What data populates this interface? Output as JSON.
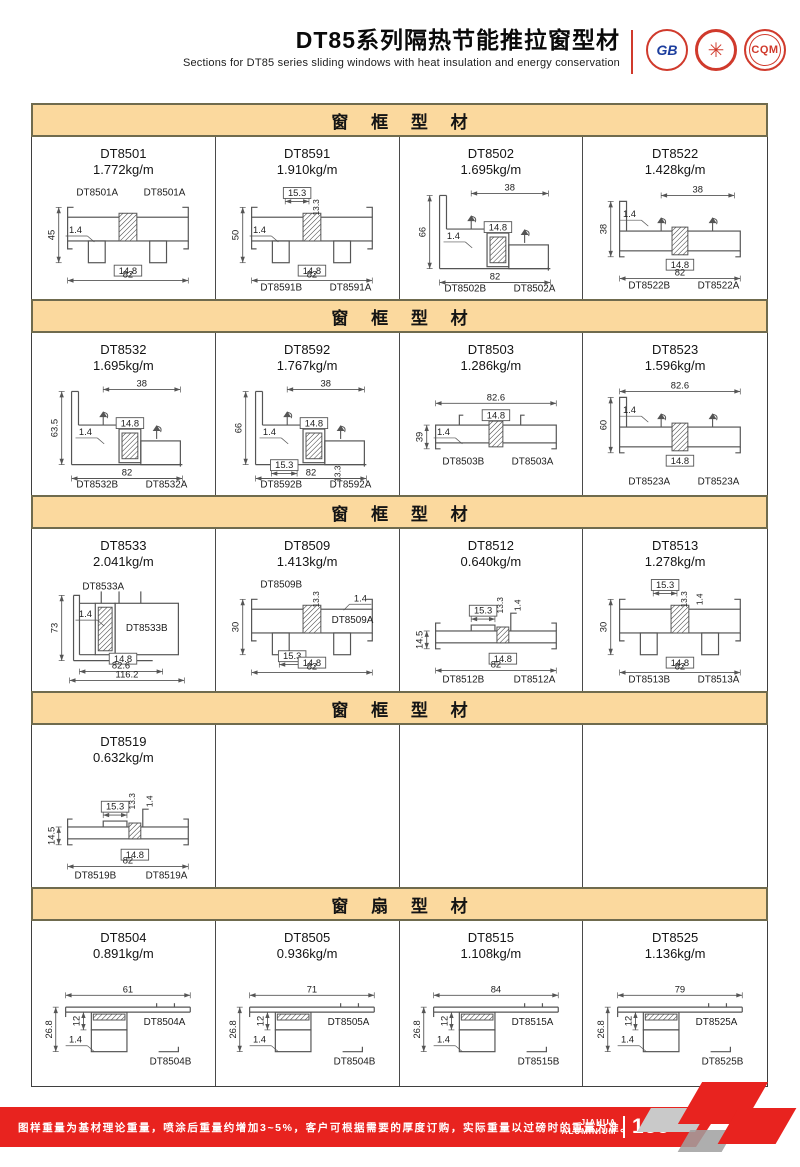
{
  "header": {
    "title": "DT85系列隔热节能推拉窗型材",
    "subtitle": "Sections for DT85 series sliding windows with heat insulation and energy conservation",
    "logos": [
      {
        "name": "gb-certification-logo",
        "text": "GB"
      },
      {
        "name": "star-seal-logo",
        "text": "✳"
      },
      {
        "name": "cqm-certification-logo",
        "text": "CQM"
      }
    ]
  },
  "sections": [
    {
      "title": "窗 框 型 材",
      "cells": [
        {
          "code": "DT8501",
          "weight": "1.772kg/m",
          "shape": "flat",
          "labels": [
            {
              "text": "DT8501A",
              "slot": "tl"
            },
            {
              "text": "DT8501A",
              "slot": "tr"
            }
          ],
          "dims": [
            {
              "text": "45",
              "slot": "left"
            },
            {
              "text": "1.4",
              "slot": "wall"
            },
            {
              "text": "14.8",
              "slot": "mid"
            },
            {
              "text": "82",
              "slot": "bottom"
            }
          ]
        },
        {
          "code": "DT8591",
          "weight": "1.910kg/m",
          "shape": "flat",
          "labels": [
            {
              "text": "DT8591B",
              "slot": "bl"
            },
            {
              "text": "DT8591A",
              "slot": "br"
            }
          ],
          "dims": [
            {
              "text": "15.3",
              "slot": "top2"
            },
            {
              "text": "13.3",
              "slot": "topv"
            },
            {
              "text": "50",
              "slot": "left"
            },
            {
              "text": "1.4",
              "slot": "wall"
            },
            {
              "text": "14.8",
              "slot": "mid"
            },
            {
              "text": "82",
              "slot": "bottom"
            }
          ]
        },
        {
          "code": "DT8502",
          "weight": "1.695kg/m",
          "shape": "step",
          "labels": [
            {
              "text": "DT8502B",
              "slot": "bl"
            },
            {
              "text": "DT8502A",
              "slot": "br"
            }
          ],
          "dims": [
            {
              "text": "38",
              "slot": "topp"
            },
            {
              "text": "66",
              "slot": "left"
            },
            {
              "text": "1.4",
              "slot": "wall"
            },
            {
              "text": "14.8",
              "slot": "mid"
            },
            {
              "text": "82",
              "slot": "bottom"
            }
          ]
        },
        {
          "code": "DT8522",
          "weight": "1.428kg/m",
          "shape": "hook",
          "labels": [
            {
              "text": "DT8522B",
              "slot": "bl"
            },
            {
              "text": "DT8522A",
              "slot": "br"
            }
          ],
          "dims": [
            {
              "text": "38",
              "slot": "topp"
            },
            {
              "text": "1.4",
              "slot": "wall"
            },
            {
              "text": "38",
              "slot": "left"
            },
            {
              "text": "14.8",
              "slot": "mid"
            },
            {
              "text": "82",
              "slot": "bottom"
            }
          ]
        }
      ]
    },
    {
      "title": "窗 框 型 材",
      "cells": [
        {
          "code": "DT8532",
          "weight": "1.695kg/m",
          "shape": "step",
          "labels": [
            {
              "text": "DT8532B",
              "slot": "bl"
            },
            {
              "text": "DT8532A",
              "slot": "br"
            }
          ],
          "dims": [
            {
              "text": "38",
              "slot": "topp"
            },
            {
              "text": "63.5",
              "slot": "left"
            },
            {
              "text": "1.4",
              "slot": "wall"
            },
            {
              "text": "14.8",
              "slot": "mid"
            },
            {
              "text": "82",
              "slot": "bottom"
            }
          ]
        },
        {
          "code": "DT8592",
          "weight": "1.767kg/m",
          "shape": "step",
          "labels": [
            {
              "text": "DT8592B",
              "slot": "bl"
            },
            {
              "text": "DT8592A",
              "slot": "br"
            }
          ],
          "dims": [
            {
              "text": "38",
              "slot": "topp"
            },
            {
              "text": "66",
              "slot": "left"
            },
            {
              "text": "1.4",
              "slot": "wall"
            },
            {
              "text": "14.8",
              "slot": "mid"
            },
            {
              "text": "15.3",
              "slot": "bottom2"
            },
            {
              "text": "13.3",
              "slot": "botv"
            },
            {
              "text": "82",
              "slot": "bottom"
            }
          ]
        },
        {
          "code": "DT8503",
          "weight": "1.286kg/m",
          "shape": "low",
          "labels": [
            {
              "text": "DT8503B",
              "slot": "bl"
            },
            {
              "text": "DT8503A",
              "slot": "br"
            }
          ],
          "dims": [
            {
              "text": "82.6",
              "slot": "top"
            },
            {
              "text": "1.4",
              "slot": "wall"
            },
            {
              "text": "14.8",
              "slot": "mid"
            },
            {
              "text": "39",
              "slot": "left"
            }
          ]
        },
        {
          "code": "DT8523",
          "weight": "1.596kg/m",
          "shape": "hook",
          "labels": [
            {
              "text": "DT8523A",
              "slot": "bl"
            },
            {
              "text": "DT8523A",
              "slot": "br"
            }
          ],
          "dims": [
            {
              "text": "82.6",
              "slot": "top"
            },
            {
              "text": "1.4",
              "slot": "wall"
            },
            {
              "text": "60",
              "slot": "left"
            },
            {
              "text": "14.8",
              "slot": "mid"
            }
          ]
        }
      ]
    },
    {
      "title": "窗 框 型 材",
      "cells": [
        {
          "code": "DT8533",
          "weight": "2.041kg/m",
          "shape": "wide",
          "labels": [
            {
              "text": "DT8533A",
              "slot": "tl"
            },
            {
              "text": "DT8533B",
              "slot": "mr"
            }
          ],
          "dims": [
            {
              "text": "1.4",
              "slot": "wall"
            },
            {
              "text": "73",
              "slot": "left"
            },
            {
              "text": "14.8",
              "slot": "mid"
            },
            {
              "text": "82.6",
              "slot": "bottom"
            },
            {
              "text": "116.2",
              "slot": "bottom2w"
            }
          ]
        },
        {
          "code": "DT8509",
          "weight": "1.413kg/m",
          "shape": "flat",
          "labels": [
            {
              "text": "DT8509B",
              "slot": "tl"
            },
            {
              "text": "DT8509A",
              "slot": "mr"
            }
          ],
          "dims": [
            {
              "text": "13.3",
              "slot": "topv"
            },
            {
              "text": "1.4",
              "slot": "wallr"
            },
            {
              "text": "30",
              "slot": "left"
            },
            {
              "text": "15.3",
              "slot": "bottom2"
            },
            {
              "text": "14.8",
              "slot": "mid"
            },
            {
              "text": "82",
              "slot": "bottom"
            }
          ]
        },
        {
          "code": "DT8512",
          "weight": "0.640kg/m",
          "shape": "thin",
          "labels": [
            {
              "text": "DT8512B",
              "slot": "bl"
            },
            {
              "text": "DT8512A",
              "slot": "br"
            }
          ],
          "dims": [
            {
              "text": "15.3",
              "slot": "top2"
            },
            {
              "text": "13.3",
              "slot": "topv"
            },
            {
              "text": "1.4",
              "slot": "topv2"
            },
            {
              "text": "14.5",
              "slot": "left"
            },
            {
              "text": "14.8",
              "slot": "mid"
            },
            {
              "text": "82",
              "slot": "bottom"
            }
          ]
        },
        {
          "code": "DT8513",
          "weight": "1.278kg/m",
          "shape": "flat",
          "labels": [
            {
              "text": "DT8513B",
              "slot": "bl"
            },
            {
              "text": "DT8513A",
              "slot": "br"
            }
          ],
          "dims": [
            {
              "text": "15.3",
              "slot": "top2"
            },
            {
              "text": "13.3",
              "slot": "topv"
            },
            {
              "text": "1.4",
              "slot": "topv2"
            },
            {
              "text": "30",
              "slot": "left"
            },
            {
              "text": "14.8",
              "slot": "mid"
            },
            {
              "text": "82",
              "slot": "bottom"
            }
          ]
        }
      ]
    },
    {
      "title": "窗 框 型 材",
      "cells": [
        {
          "code": "DT8519",
          "weight": "0.632kg/m",
          "shape": "thin",
          "labels": [
            {
              "text": "DT8519B",
              "slot": "bl"
            },
            {
              "text": "DT8519A",
              "slot": "br"
            }
          ],
          "dims": [
            {
              "text": "15.3",
              "slot": "top2"
            },
            {
              "text": "13.3",
              "slot": "topv"
            },
            {
              "text": "1.4",
              "slot": "topv2"
            },
            {
              "text": "14.5",
              "slot": "left"
            },
            {
              "text": "14.8",
              "slot": "mid"
            },
            {
              "text": "82",
              "slot": "bottom"
            }
          ]
        },
        null,
        null,
        null
      ]
    },
    {
      "title": "窗 扇 型 材",
      "cells": [
        {
          "code": "DT8504",
          "weight": "0.891kg/m",
          "shape": "sash",
          "labels": [
            {
              "text": "DT8504A",
              "slot": "mr"
            },
            {
              "text": "DT8504B",
              "slot": "br"
            }
          ],
          "dims": [
            {
              "text": "61",
              "slot": "top"
            },
            {
              "text": "12",
              "slot": "inner"
            },
            {
              "text": "26.8",
              "slot": "left"
            },
            {
              "text": "1.4",
              "slot": "wall"
            }
          ]
        },
        {
          "code": "DT8505",
          "weight": "0.936kg/m",
          "shape": "sash",
          "labels": [
            {
              "text": "DT8505A",
              "slot": "mr"
            },
            {
              "text": "DT8504B",
              "slot": "br"
            }
          ],
          "dims": [
            {
              "text": "71",
              "slot": "top"
            },
            {
              "text": "12",
              "slot": "inner"
            },
            {
              "text": "26.8",
              "slot": "left"
            },
            {
              "text": "1.4",
              "slot": "wall"
            }
          ]
        },
        {
          "code": "DT8515",
          "weight": "1.108kg/m",
          "shape": "sash",
          "labels": [
            {
              "text": "DT8515A",
              "slot": "mr"
            },
            {
              "text": "DT8515B",
              "slot": "br"
            }
          ],
          "dims": [
            {
              "text": "84",
              "slot": "top"
            },
            {
              "text": "12",
              "slot": "inner"
            },
            {
              "text": "26.8",
              "slot": "left"
            },
            {
              "text": "1.4",
              "slot": "wall"
            }
          ]
        },
        {
          "code": "DT8525",
          "weight": "1.136kg/m",
          "shape": "sash",
          "labels": [
            {
              "text": "DT8525A",
              "slot": "mr"
            },
            {
              "text": "DT8525B",
              "slot": "br"
            }
          ],
          "dims": [
            {
              "text": "79",
              "slot": "top"
            },
            {
              "text": "12",
              "slot": "inner"
            },
            {
              "text": "26.8",
              "slot": "left"
            },
            {
              "text": "1.4",
              "slot": "wall"
            }
          ]
        }
      ]
    }
  ],
  "footer": {
    "note": "图样重量为基材理论重量，喷涂后重量约增加3~5%，客户可根据需要的厚度订购，实际重量以过磅时的重量为准。",
    "brand_line1": "JIAHUA",
    "brand_line2": "ALUMINIUM",
    "page_number": "155"
  },
  "colors": {
    "band_bg": "#FBD99E",
    "band_border": "#6F6B4E",
    "accent_red": "#E8231F",
    "drawing_stroke": "#555555"
  }
}
